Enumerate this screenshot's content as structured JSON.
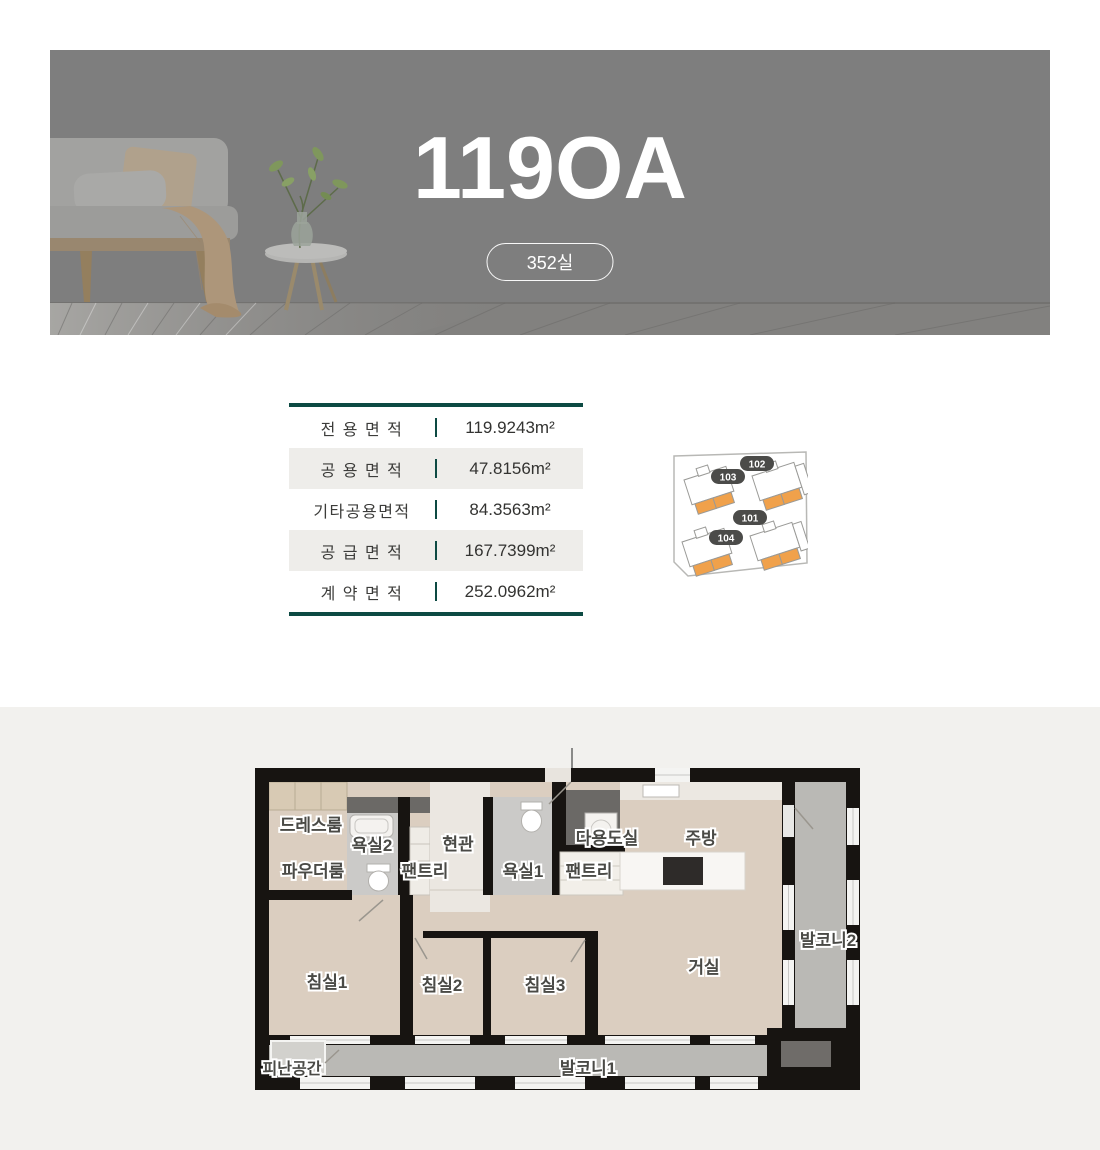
{
  "hero": {
    "title": "119OA",
    "unit_count_badge": "352실",
    "bg_color": "#7e7e7e"
  },
  "area_table": {
    "accent_color": "#0d4a43",
    "alt_row_color": "#eeedea",
    "rows": [
      {
        "label": "전 용 면 적",
        "value": "119.9243m²"
      },
      {
        "label": "공 용 면 적",
        "value": "47.8156m²"
      },
      {
        "label": "기타공용면적",
        "value": "84.3563m²"
      },
      {
        "label": "공 급 면 적",
        "value": "167.7399m²"
      },
      {
        "label": "계 약 면 적",
        "value": "252.0962m²"
      }
    ]
  },
  "key_plan": {
    "highlight_color": "#f0a14b",
    "badge_color": "#4b4b49",
    "unit_badges": [
      {
        "id": "102"
      },
      {
        "id": "103"
      },
      {
        "id": "101"
      },
      {
        "id": "104"
      }
    ]
  },
  "floor_plan": {
    "wall_color": "#171411",
    "floor_color": "#dbcec0",
    "balcony_color": "#bab9b5",
    "rooms": [
      {
        "label": "드레스룸"
      },
      {
        "label": "욕실2"
      },
      {
        "label": "현관"
      },
      {
        "label": "파우더룸"
      },
      {
        "label": "팬트리"
      },
      {
        "label": "욕실1"
      },
      {
        "label": "다용도실"
      },
      {
        "label": "팬트리"
      },
      {
        "label": "주방"
      },
      {
        "label": "발코니2"
      },
      {
        "label": "침실1"
      },
      {
        "label": "침실2"
      },
      {
        "label": "침실3"
      },
      {
        "label": "거실"
      },
      {
        "label": "피난공간"
      },
      {
        "label": "발코니1"
      }
    ]
  }
}
